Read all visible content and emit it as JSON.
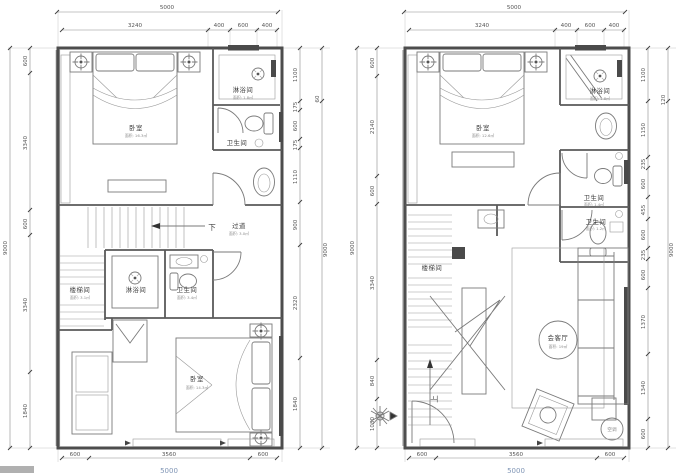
{
  "colors": {
    "wall": "#4d4d4d",
    "line": "#7a7a7a",
    "dim_text": "#555555",
    "room_text": "#3f3f3f",
    "clipped_total_blue": "#7f95b5",
    "artifact_gray": "#b0b0b0"
  },
  "left_plan": {
    "dims": {
      "top_total": "5000",
      "top_segs": [
        "3240",
        "400",
        "600",
        "400"
      ],
      "left_total": "9000",
      "left_segs": [
        "600",
        "3340",
        "600",
        "3340",
        "1840"
      ],
      "right_segs": [
        "1100",
        "175",
        "600",
        "175",
        "1110",
        "900",
        "2320",
        "1840"
      ],
      "right_outer_seg": "60",
      "right_total": "9000",
      "bottom_segs": [
        "600",
        "3560",
        "600"
      ],
      "bottom_total": "5000"
    },
    "rooms": {
      "bedroom_top": {
        "name": "卧室",
        "area": "面积: 16.3㎡"
      },
      "shower_top": {
        "name": "淋浴间",
        "area": "面积: 1.8㎡"
      },
      "toilet_top": {
        "name": "卫生间"
      },
      "corridor": {
        "name": "过道",
        "area": "面积: 3.0㎡"
      },
      "down_arrow": "下",
      "stair_room": {
        "name": "楼梯间",
        "area": "面积: 3.1㎡"
      },
      "shower_mid": {
        "name": "淋浴间"
      },
      "toilet_mid": {
        "name": "卫生间",
        "area": "面积: 3.4㎡"
      },
      "bedroom_bottom": {
        "name": "卧室",
        "area": "面积: 14.3㎡"
      }
    }
  },
  "right_plan": {
    "dims": {
      "top_total": "5000",
      "top_segs": [
        "3240",
        "400",
        "600",
        "400"
      ],
      "left_total": "9000",
      "left_segs": [
        "600",
        "2140",
        "600",
        "3340",
        "840",
        "1080"
      ],
      "right_segs": [
        "1100",
        "1150",
        "235",
        "600",
        "455",
        "600",
        "235",
        "600",
        "1370",
        "1340",
        "600"
      ],
      "right_outer_seg": "120",
      "right_total": "9000",
      "bottom_segs": [
        "600",
        "3560",
        "600"
      ],
      "bottom_total": "5000"
    },
    "rooms": {
      "bedroom": {
        "name": "卧室",
        "area": "面积: 12.6㎡"
      },
      "shower": {
        "name": "淋浴间",
        "area": "面积: 1.8㎡"
      },
      "toilet_upper": {
        "name": "卫生间",
        "area": "面积: 1.4㎡"
      },
      "toilet_lower": {
        "name": "卫生间",
        "area": "面积: 1.2㎡"
      },
      "stair_room": {
        "name": "楼梯间"
      },
      "living": {
        "name": "会客厅",
        "area": "面积: 19㎡"
      },
      "up_arrow": "上",
      "ac": "空调"
    }
  }
}
